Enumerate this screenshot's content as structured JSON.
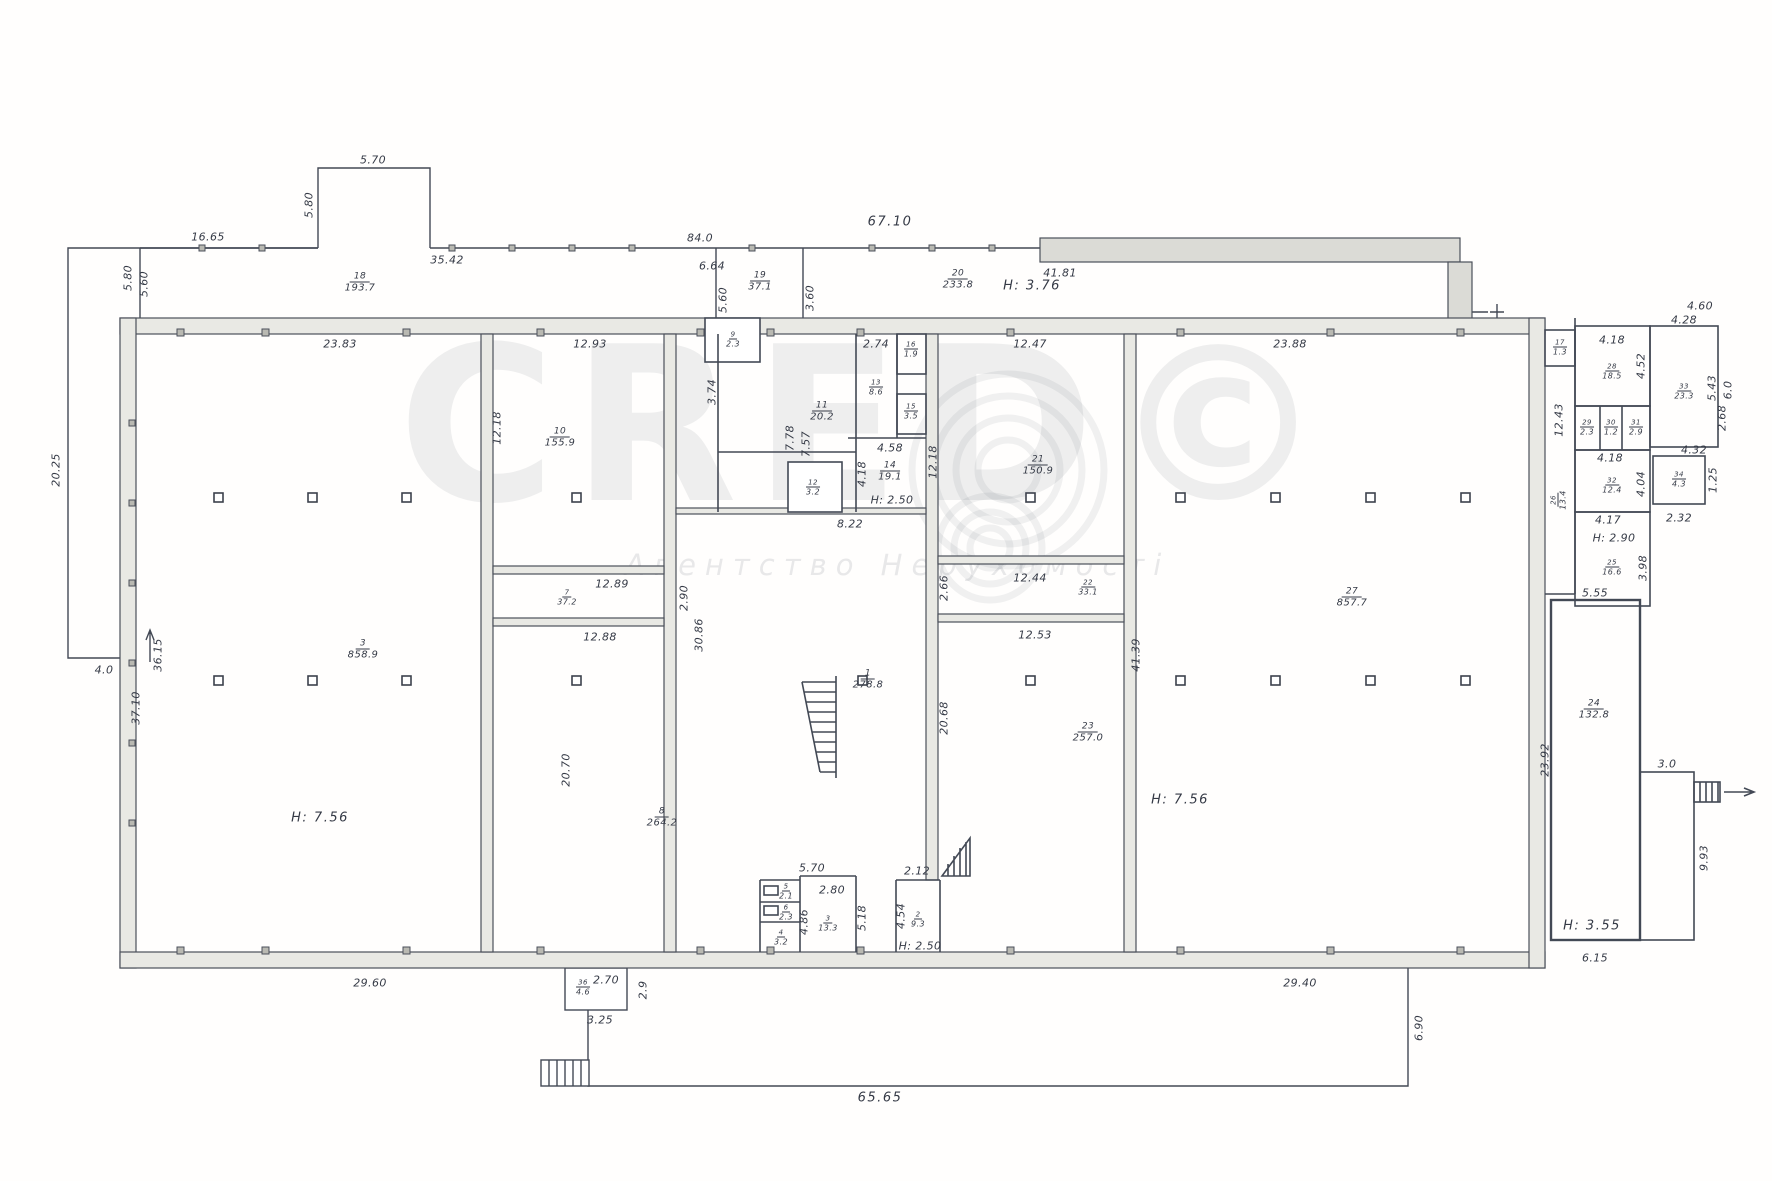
{
  "watermark": {
    "brand": "CRED©",
    "subtitle": "Агентство Нерухомості"
  },
  "labels": {
    "d5_70": "5.70",
    "d5_80a": "5.80",
    "d16_65": "16.65",
    "d35_42": "35.42",
    "d84_0": "84.0",
    "d6_64": "6.64",
    "d67_10": "67.10",
    "d41_81": "41.81",
    "d5_80b": "5.80",
    "d5_60a": "5.60",
    "d5_60b": "5.60",
    "d3_60": "3.60",
    "h3_76": "H: 3.76",
    "d23_83": "23.83",
    "d12_93": "12.93",
    "d12_47": "12.47",
    "d23_88": "23.88",
    "d20_25": "20.25",
    "d4_0": "4.0",
    "d36_15": "36.15",
    "d37_10": "37.10",
    "h7_56a": "H: 7.56",
    "d29_60": "29.60",
    "d12_18a": "12.18",
    "d12_89": "12.89",
    "d2_90": "2.90",
    "d12_88": "12.88",
    "d20_70": "20.70",
    "d3_74": "3.74",
    "d7_78": "7.78",
    "d7_57": "7.57",
    "d2_74": "2.74",
    "d4_58": "4.58",
    "h2_50a": "H: 2.50",
    "d4_18a": "4.18",
    "d8_22": "8.22",
    "d12_18b": "12.18",
    "d30_86": "30.86",
    "d20_68": "20.68",
    "d2_66": "2.66",
    "d12_44": "12.44",
    "d12_53": "12.53",
    "d41_39": "41.39",
    "h7_56b": "H: 7.56",
    "d29_40": "29.40",
    "d6_15": "6.15",
    "d5_55": "5.55",
    "d23_92": "23.92",
    "h3_55": "H: 3.55",
    "d3_0": "3.0",
    "d9_93": "9.93",
    "d12_43": "12.43",
    "d4_18b": "4.18",
    "d4_52": "4.52",
    "d4_18c": "4.18",
    "d4_04": "4.04",
    "d4_17": "4.17",
    "h2_90": "H: 2.90",
    "d3_98": "3.98",
    "d4_28": "4.28",
    "d4_60": "4.60",
    "d5_43": "5.43",
    "d6_0": "6.0",
    "d2_68": "2.68",
    "d4_32": "4.32",
    "d2_32": "2.32",
    "d1_25": "1.25",
    "d5_70b": "5.70",
    "d2_80": "2.80",
    "d4_86": "4.86",
    "d5_18": "5.18",
    "d2_12": "2.12",
    "d4_54": "4.54",
    "h2_50b": "H: 2.50",
    "d2_70": "2.70",
    "d3_25": "3.25",
    "d2_9": "2.9",
    "d65_65": "65.65",
    "d6_90": "6.90"
  },
  "rooms": {
    "r18": {
      "num": "18",
      "area": "193.7"
    },
    "r19": {
      "num": "19",
      "area": "37.1"
    },
    "r20": {
      "num": "20",
      "area": "233.8"
    },
    "r3": {
      "num": "3",
      "area": "858.9"
    },
    "r10": {
      "num": "10",
      "area": "155.9"
    },
    "r7": {
      "num": "7",
      "area": "37.2"
    },
    "r8": {
      "num": "8",
      "area": "264.2"
    },
    "r9": {
      "num": "9",
      "area": "2.3"
    },
    "r11": {
      "num": "11",
      "area": "20.2"
    },
    "r12": {
      "num": "12",
      "area": "3.2"
    },
    "r13": {
      "num": "13",
      "area": "8.6"
    },
    "r14": {
      "num": "14",
      "area": "19.1"
    },
    "r15": {
      "num": "15",
      "area": "3.5"
    },
    "r16": {
      "num": "16",
      "area": "1.9"
    },
    "r1": {
      "num": "1",
      "area": "278.8"
    },
    "r21": {
      "num": "21",
      "area": "150.9"
    },
    "r22": {
      "num": "22",
      "area": "33.1"
    },
    "r23": {
      "num": "23",
      "area": "257.0"
    },
    "r27": {
      "num": "27",
      "area": "857.7"
    },
    "r24": {
      "num": "24",
      "area": "132.8"
    },
    "r17": {
      "num": "17",
      "area": "1.3"
    },
    "r28": {
      "num": "28",
      "area": "18.5"
    },
    "r29": {
      "num": "29",
      "area": "2.3"
    },
    "r30": {
      "num": "30",
      "area": "1.2"
    },
    "r31": {
      "num": "31",
      "area": "2.9"
    },
    "r32": {
      "num": "32",
      "area": "12.4"
    },
    "r25": {
      "num": "25",
      "area": "16.6"
    },
    "r26": {
      "num": "26",
      "area": "13.4"
    },
    "r33": {
      "num": "33",
      "area": "23.3"
    },
    "r34": {
      "num": "34",
      "area": "4.3"
    },
    "r36": {
      "num": "36",
      "area": "4.6"
    },
    "r2": {
      "num": "2",
      "area": "9.3"
    },
    "r3b": {
      "num": "3",
      "area": "13.3"
    },
    "r4": {
      "num": "4",
      "area": "3.2"
    },
    "r5": {
      "num": "5",
      "area": "2.1"
    },
    "r6": {
      "num": "6",
      "area": "2.3"
    }
  }
}
